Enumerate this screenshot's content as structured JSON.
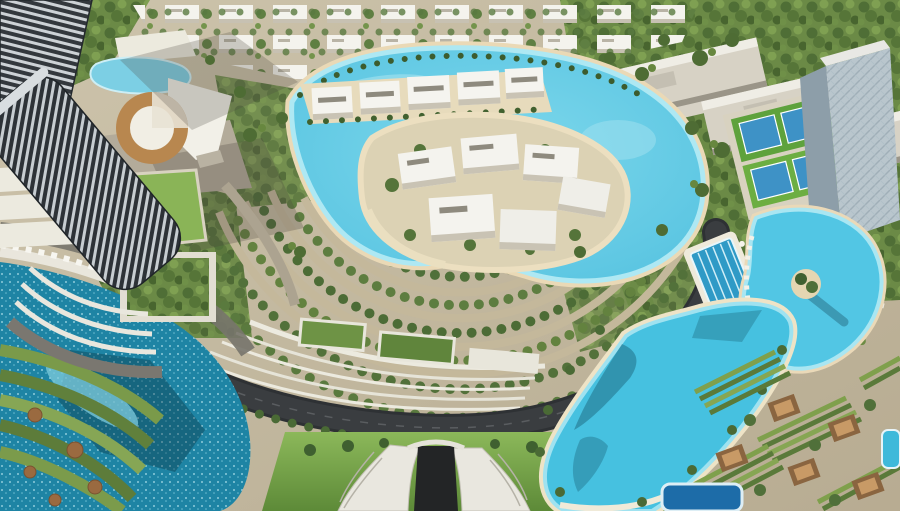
{
  "scene": {
    "type": "aerial-masterplan-render",
    "features": [
      "villa-district-rows",
      "central-crystal-lagoon",
      "lagoon-island-mansions",
      "waterfront-villas",
      "left-residential-towers",
      "round-clubhouse",
      "school-campus",
      "tennis-courts",
      "right-glass-tower",
      "lap-pool",
      "palm-island-pool",
      "crescent-lagoon",
      "dark-lagoon",
      "ring-boulevards",
      "highway-loop",
      "road-tunnel-entrance",
      "terraced-gardens",
      "cabana-courtyards"
    ],
    "palette": {
      "ground": "#c5bba2",
      "forest": "#5f7e3e",
      "lagoon_main": "#66cbe4",
      "lagoon_dark": "#1e84a4",
      "lagoon_crescent": "#46c1e0",
      "lagoon_shallow": "#aee8f3",
      "sand": "#ead9b6",
      "road_dark": "#3a3d40",
      "road_tan": "#c4b89b",
      "lawn": "#76a348",
      "terrace_white": "#eceadf",
      "building_white": "#f4f3ed",
      "tower_dark": "#2d3237",
      "tower_light": "#c7cdd1",
      "bronze": "#b8874f",
      "court_green": "#5ea23c",
      "court_blue": "#3e92c6",
      "deck": "#e9e6dc",
      "pool_lane": "#2f9ac6"
    }
  }
}
